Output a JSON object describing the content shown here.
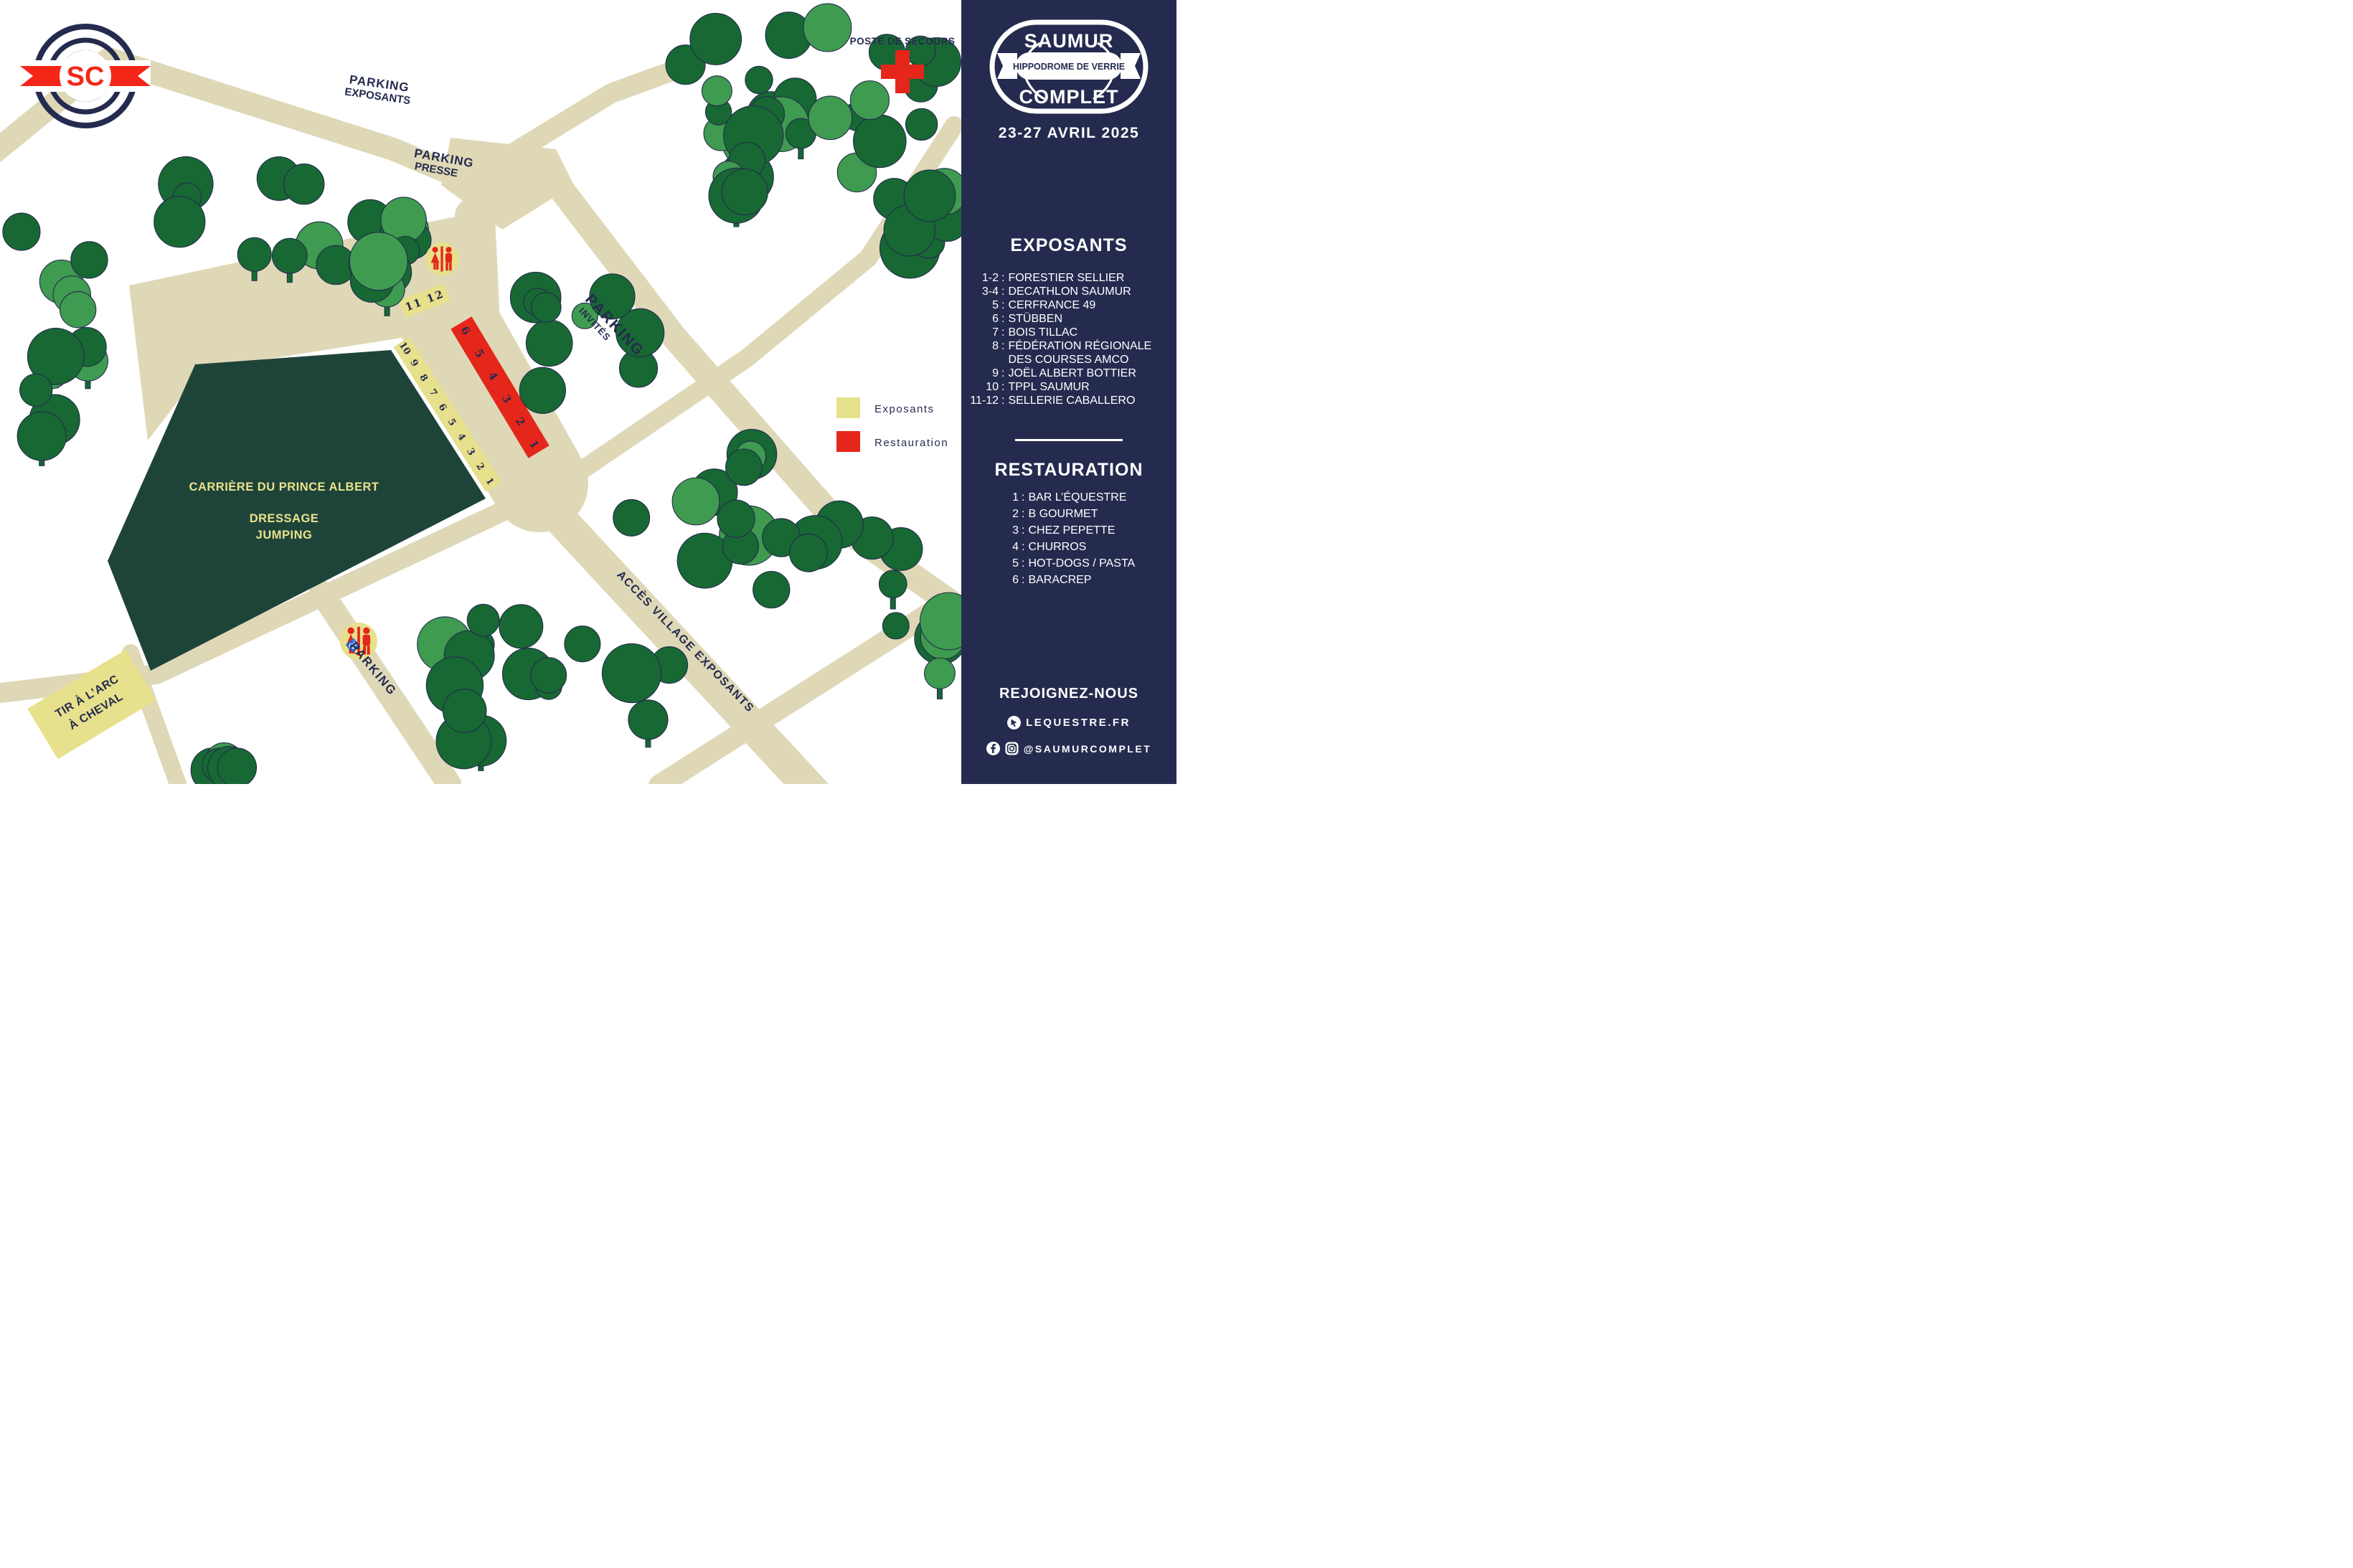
{
  "colors": {
    "navy": "#252b4f",
    "beige": "#ded8b7",
    "yellow": "#e7e08c",
    "red": "#e5261a",
    "tree_dark": "#176833",
    "tree_light": "#3f9b4f",
    "arena_green": "#1e443a",
    "pale_yellow": "#eae38b",
    "white": "#ffffff",
    "logo_red": "#f42617"
  },
  "sidebar": {
    "logo": {
      "top": "SAUMUR",
      "middle": "HIPPODROME DE VERRIE",
      "bottom": "COMPLET"
    },
    "dates": "23-27 AVRIL 2025",
    "exposants": {
      "heading": "EXPOSANTS",
      "items": [
        {
          "num": "1-2",
          "name": "FORESTIER SELLIER"
        },
        {
          "num": "3-4",
          "name": "DECATHLON SAUMUR"
        },
        {
          "num": "5",
          "name": "CERFRANCE 49"
        },
        {
          "num": "6",
          "name": "STÜBBEN"
        },
        {
          "num": "7",
          "name": "BOIS TILLAC"
        },
        {
          "num": "8",
          "name": "FÉDÉRATION RÉGIONALE\nDES COURSES AMCO"
        },
        {
          "num": "9",
          "name": "JOËL ALBERT BOTTIER"
        },
        {
          "num": "10",
          "name": "TPPL SAUMUR"
        },
        {
          "num": "11-12",
          "name": "SELLERIE CABALLERO"
        }
      ]
    },
    "restauration": {
      "heading": "RESTAURATION",
      "items": [
        {
          "num": "1",
          "name": "BAR L’ÉQUESTRE"
        },
        {
          "num": "2",
          "name": "B GOURMET"
        },
        {
          "num": "3",
          "name": "CHEZ PEPETTE"
        },
        {
          "num": "4",
          "name": "CHURROS"
        },
        {
          "num": "5",
          "name": "HOT-DOGS / PASTA"
        },
        {
          "num": "6",
          "name": "BARACREP"
        }
      ]
    },
    "join": {
      "heading": "REJOIGNEZ-NOUS",
      "website": "LEQUESTRE.FR",
      "social": "@SAUMURCOMPLET"
    }
  },
  "map": {
    "labels": {
      "parking_exposants_1": "PARKING",
      "parking_exposants_2": "EXPOSANTS",
      "parking_presse_1": "PARKING",
      "parking_presse_2": "PRESSE",
      "parking_invites_1": "PARKING",
      "parking_invites_2": "INVITÉS",
      "poste_de_secours": "POSTE DE SECOURS",
      "acces_village": "ACCÈS VILLAGE EXPOSANTS",
      "parking_bottom": "PARKING",
      "wheelchair": "♿",
      "tir_arc_1": "TIR À L’ARC",
      "tir_arc_2": "À CHEVAL",
      "stands_11_12": "11 12",
      "arena_title": "CARRIÈRE DU PRINCE ALBERT",
      "arena_line2": "DRESSAGE",
      "arena_line3": "JUMPING"
    },
    "legend": {
      "exposants": "Exposants",
      "restauration": "Restauration"
    },
    "exposant_stand_numbers": [
      "10",
      "9",
      "8",
      "7",
      "6",
      "5",
      "4",
      "3",
      "2",
      "1"
    ],
    "restauration_stand_numbers": [
      "6",
      "5",
      "4",
      "3",
      "2",
      "1"
    ],
    "sc_logo_text": "SC"
  }
}
